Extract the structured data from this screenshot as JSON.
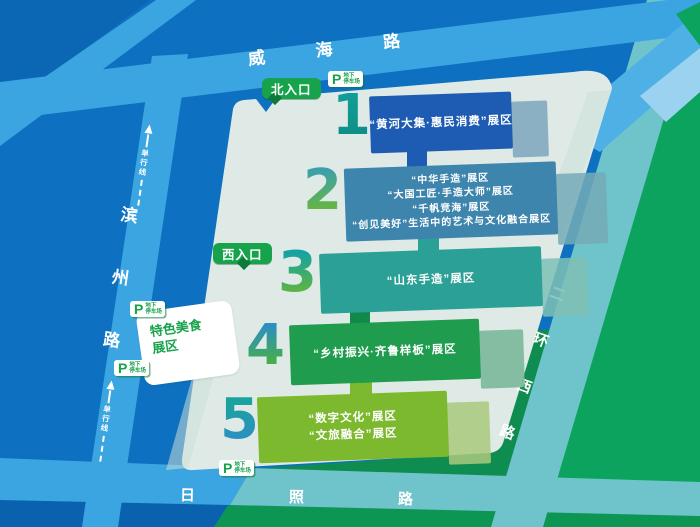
{
  "map": {
    "roads": {
      "weihai": "威海路",
      "binzhou": "滨州路",
      "erhuan": "二环西路",
      "rizhao": "日照路",
      "oneway_label": "单行线"
    },
    "entrances": {
      "north": "北入口",
      "west": "西入口"
    },
    "parking": {
      "symbol": "P",
      "line1": "地下",
      "line2": "停车场",
      "locations": [
        "north",
        "west-upper",
        "west-lower",
        "south"
      ]
    },
    "food_zone": {
      "line1": "特色美食",
      "line2": "展区"
    },
    "zones": [
      {
        "num": "1",
        "lines": [
          "“黄河大集·惠民消费”展区"
        ],
        "box_color": "#1e5cb3",
        "slab_color": "#7da6bd",
        "connector_color": "#1e5cb3",
        "num_grad_top": "#0f9e96",
        "num_grad_bottom": "#0c8f88"
      },
      {
        "num": "2",
        "lines": [
          "“中华手造”展区",
          "“大国工匠·手造大师”展区",
          "“千帆竞海”展区",
          "“创见美好”生活中的艺术与文化融合展区"
        ],
        "box_color": "#3e85ad",
        "slab_color": "#74aab6",
        "connector_color": "#2ba096",
        "num_grad_top": "#3ba0ab",
        "num_grad_bottom": "#68b73c"
      },
      {
        "num": "3",
        "lines": [
          "“山东手造”展区"
        ],
        "box_color": "#2ba096",
        "slab_color": "#7fbfb5",
        "connector_color": "#11894a",
        "num_grad_top": "#14a3a2",
        "num_grad_bottom": "#63b43e"
      },
      {
        "num": "4",
        "lines": [
          "“乡村振兴·齐鲁样板”展区"
        ],
        "box_color": "#1f9c4d",
        "slab_color": "#74b594",
        "connector_color": "#7cb92e",
        "num_grad_top": "#2b8fc3",
        "num_grad_bottom": "#49b13d"
      },
      {
        "num": "5",
        "lines": [
          "“数字文化”展区",
          "“文旅融合”展区"
        ],
        "box_color": "#7cb92e",
        "slab_color": "#a9c97d",
        "connector_color": "",
        "num_grad_top": "#18a49c",
        "num_grad_bottom": "#2e8fc4"
      }
    ],
    "colors": {
      "bg_blue": "#0d70c0",
      "bg_blue_dark": "#0a62ae",
      "bg_blue_corner": "#0b66b4",
      "road_blue": "#3ba5e2",
      "stripe_blue": "#4fb0e6",
      "stripe_pale": "#9ad2ef",
      "venue": "#dfeae6",
      "venue_shadow": "#cbded7",
      "green_bg": "#0ba35d",
      "green_dark": "#0d9554",
      "teal_road": "#6ec4ca",
      "strip_green": "#0f8c4f",
      "badge_green": "#16a34b",
      "badge_tail": "#0d7a38",
      "parking_green": "#16a34b"
    }
  }
}
